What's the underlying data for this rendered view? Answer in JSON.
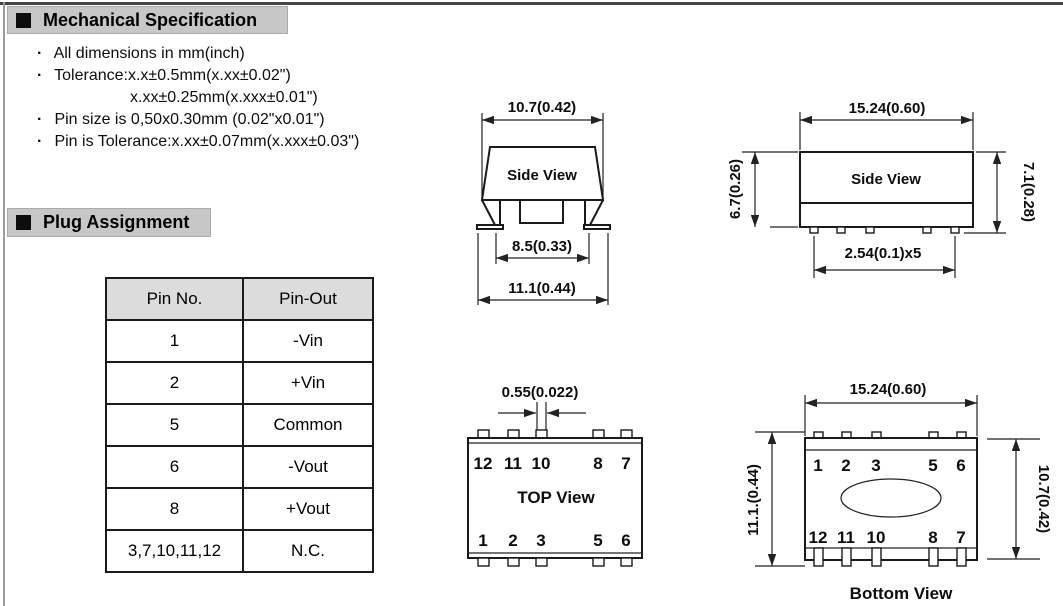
{
  "page": {
    "bg": "#ffffff",
    "line_color": "#222222",
    "section_bar_bg": "#c7c7c7",
    "table_header_bg": "#dcdcdc"
  },
  "sections": {
    "mechanical": "Mechanical Specification",
    "plug": "Plug Assignment"
  },
  "bullet_char": "·",
  "notes": [
    "All dimensions in mm(inch)",
    "Tolerance:x.x±0.5mm(x.xx±0.02\")",
    "x.xx±0.25mm(x.xxx±0.01\")",
    "Pin size is 0,50x0.30mm (0.02\"x0.01\")",
    "Pin is Tolerance:x.xx±0.07mm(x.xxx±0.03\")"
  ],
  "pin_table": {
    "col_headers": [
      "Pin No.",
      "Pin-Out"
    ],
    "rows": [
      [
        "1",
        "-Vin"
      ],
      [
        "2",
        "+Vin"
      ],
      [
        "5",
        "Common"
      ],
      [
        "6",
        "-Vout"
      ],
      [
        "8",
        "+Vout"
      ],
      [
        "3,7,10,11,12",
        "N.C."
      ]
    ]
  },
  "drawings": {
    "side_view_front": {
      "label": "Side View",
      "dim_top_width": "10.7(0.42)",
      "dim_inner_width": "8.5(0.33)",
      "dim_overall_width": "11.1(0.44)"
    },
    "side_view_long": {
      "label": "Side View",
      "dim_width": "15.24(0.60)",
      "dim_body_height": "6.7(0.26)",
      "dim_overall_height": "7.1(0.28)",
      "dim_pin_pitch": "2.54(0.1)x5"
    },
    "top_view": {
      "label": "TOP View",
      "dim_pin_width": "0.55(0.022)",
      "pins_top": [
        "12",
        "11",
        "10",
        "8",
        "7"
      ],
      "pins_bottom": [
        "1",
        "2",
        "3",
        "5",
        "6"
      ]
    },
    "bottom_view": {
      "label": "Bottom View",
      "dim_width": "15.24(0.60)",
      "dim_overall_height": "11.1.(0.44)",
      "dim_body_height": "10.7(0.42)",
      "pins_top": [
        "1",
        "2",
        "3",
        "5",
        "6"
      ],
      "pins_bottom": [
        "12",
        "11",
        "10",
        "8",
        "7"
      ]
    }
  }
}
